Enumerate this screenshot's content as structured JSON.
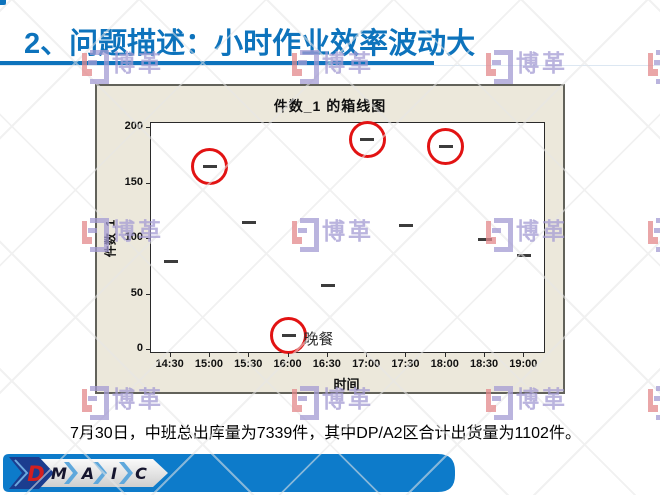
{
  "slide": {
    "title": "2、问题描述：小时作业效率波动大",
    "accent_color": "#0d73bc",
    "footer_note": "7月30日，中班总出库量为7339件，其中DP/A2区合计出货量为1102件。"
  },
  "watermark": {
    "text": "博革"
  },
  "chart_data": {
    "type": "scatter",
    "marker": "median-dash",
    "title": "件数_1  的箱线图",
    "xlabel": "时间",
    "ylabel": "件数_1",
    "categories": [
      "14:30",
      "15:00",
      "15:30",
      "16:00",
      "16:30",
      "17:00",
      "17:30",
      "18:00",
      "18:30",
      "19:00"
    ],
    "values": [
      80,
      165,
      115,
      13,
      58,
      190,
      112,
      183,
      100,
      85
    ],
    "ylim": [
      0,
      200
    ],
    "yticks": [
      0,
      50,
      100,
      150,
      200
    ],
    "grid": false,
    "legend": "none",
    "panel_bg": "#ece8db",
    "plot_bg": "#ffffff",
    "highlight_color": "#e21313",
    "circled_categories": [
      "15:00",
      "16:00",
      "17:00",
      "18:00"
    ],
    "annotation": {
      "text": "晚餐",
      "category": "16:00"
    }
  },
  "dmaic": {
    "letters": [
      "D",
      "M",
      "A",
      "I",
      "C"
    ],
    "bar_color": "#0d7bca",
    "chevron_navy": "#1b3d8f",
    "d_color": "#d31f1f",
    "letter_color": "#15152e"
  }
}
